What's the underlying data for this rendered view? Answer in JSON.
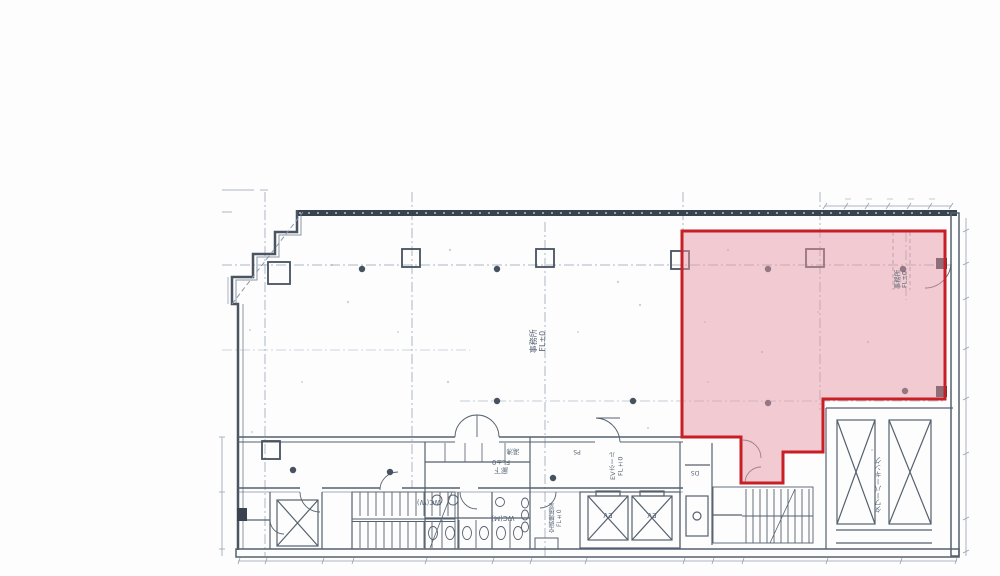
{
  "drawing": {
    "type": "scanned-floor-plan",
    "highlight_fill": "#e59aa6",
    "highlight_border": "#c81e25",
    "line_color": "#55616e",
    "wall_color": "#39434f"
  },
  "labels": {
    "office_main": {
      "text": "事務所",
      "sub": "FL±0"
    },
    "office_highlight": {
      "text": "事務所",
      "sub": "FL±0"
    },
    "corridor": {
      "text": "廊下",
      "sub": "FL±0"
    },
    "ev_hall": {
      "text": "EVホール",
      "sub": "FL±0"
    },
    "ac_room": {
      "text": "空調機械室",
      "sub": "FL±0"
    },
    "wc_w": {
      "text": "WC(W)"
    },
    "wc_m": {
      "text": "WC(M)"
    },
    "ev_left": {
      "text": "EV"
    },
    "ev_right": {
      "text": "EV"
    },
    "parking": {
      "text": "タワーパーキング"
    },
    "yuwakashi": {
      "text": "湯沸"
    },
    "ps": {
      "text": "PS"
    },
    "ds": {
      "text": "DS"
    }
  }
}
